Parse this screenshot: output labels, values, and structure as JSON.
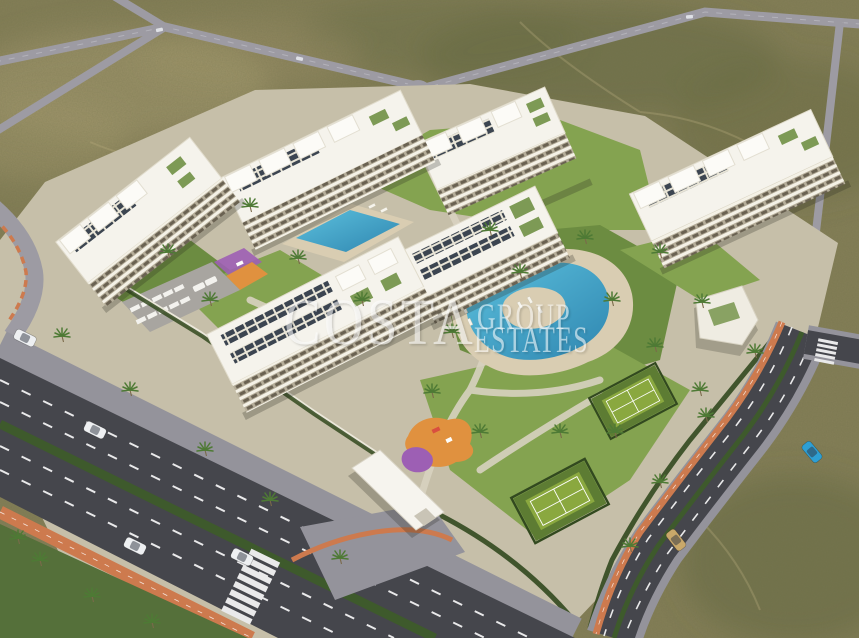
{
  "scene": {
    "type": "aerial-architectural-render",
    "description": "Aerial 3D render of a gated residential apartment complex with six white apartment blocks, a lagoon pool, a lap pool, two tennis courts, playgrounds and landscaped gardens, surrounded by scrubland, a palm-lined avenue and new roads with orange bike lanes"
  },
  "watermark": {
    "line1": "COSTA",
    "line2": "GROUP",
    "line3": "ESTATES"
  },
  "colors": {
    "scrub_base": "#857f58",
    "scrub_light": "#a89d72",
    "scrub_dark": "#646a42",
    "road_distant": "#9d9ba3",
    "road_edge": "#b9b8bf",
    "asphalt": "#45464c",
    "sidewalk": "#94939b",
    "bike_lane": "#cd7a4e",
    "median_hedge": "#3e5a2c",
    "lane_marking": "#e9e9ea",
    "lawn": "#84a350",
    "lawn_dark": "#6c8c41",
    "path": "#d8d2c0",
    "parcel_ground": "#c6bfa9",
    "building_white": "#f5f3ec",
    "building_face": "#b6ae9a",
    "building_band": "#f4f1e6",
    "window_dark": "#6a6252",
    "solar_panel": "#3c4551",
    "pool_deep": "#2f86b0",
    "pool_light": "#5cc0dd",
    "pool_deck": "#d9cdb2",
    "tennis_court": "#8aa83f",
    "tennis_border": "#5d7c33",
    "playground_orange": "#e0913f",
    "playground_purple": "#9d5fb4",
    "palm_green": "#4e7a35",
    "hedge_dark": "#32491f",
    "wall_white": "#ece8db",
    "car_white": "#eef0f2",
    "car_blue": "#2e9fd4",
    "car_tan": "#c9a86a",
    "watermark": "#ffffff"
  }
}
